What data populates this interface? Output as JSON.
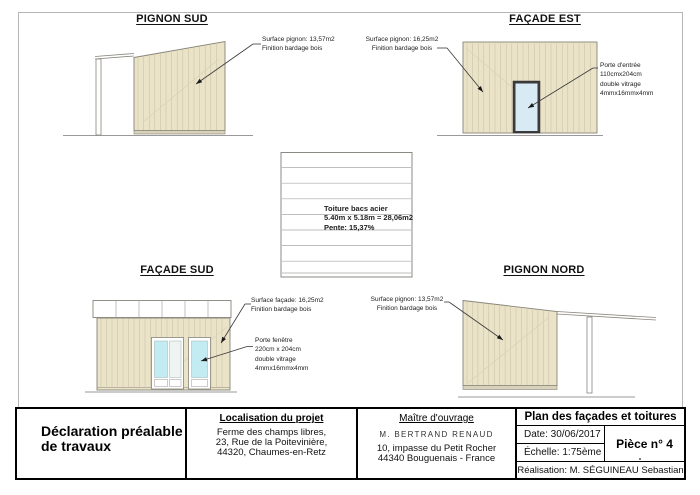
{
  "colors": {
    "cladding_fill": "#eae3c7",
    "cladding_line": "#c6bea2",
    "plinth_fill": "#d9d2ba",
    "outline": "#87847a",
    "glass_blue": "#c2ecf2",
    "glass_pale": "#edf4f2",
    "door_glass": "#d8ebf4",
    "door_frame": "#3c3c3c"
  },
  "views": {
    "pignon_sud": {
      "title": "PIGNON SUD",
      "surface": [
        "Surface pignon: 13,57m2",
        "Finition bardage bois"
      ]
    },
    "facade_est": {
      "title": "FAÇADE EST",
      "surface": [
        "Surface pignon: 16,25m2",
        "Finition bardage bois"
      ],
      "door": [
        "Porte d'entrée",
        "110cmx204cm",
        "double vitrage",
        "4mmx16mmx4mm"
      ]
    },
    "roof_plan": {
      "label": [
        "Toiture bacs acier",
        "5.40m x 5.18m = 28,06m2",
        "Pente: 15,37%"
      ]
    },
    "facade_sud": {
      "title": "FAÇADE SUD",
      "surface": [
        "Surface façade: 16,25m2",
        "Finition bardage bois"
      ],
      "window": [
        "Porte fenêtre",
        "220cm x 204cm",
        "double vitrage",
        "4mmx16mmx4mm"
      ]
    },
    "pignon_nord": {
      "title": "PIGNON NORD",
      "surface": [
        "Surface pignon: 13,57m2",
        "Finition bardage bois"
      ]
    }
  },
  "title_block": {
    "declaration": [
      "Déclaration préalable",
      "de travaux"
    ],
    "localisation": {
      "header": "Localisation du projet",
      "address": [
        "Ferme des champs libres,",
        "23, Rue de la Poitevinière,",
        "44320, Chaumes-en-Retz"
      ]
    },
    "maitre_ouvrage": {
      "header": "Maître d'ouvrage",
      "name": "M. BERTRAND RENAUD",
      "address": [
        "10, impasse du Petit Rocher",
        "44340 Bouguenais - France"
      ]
    },
    "plan": {
      "title": "Plan des façades et toitures",
      "date": "Date: 30/06/2017",
      "scale": "Échelle: 1:75ème",
      "piece": "Pièce n° 4",
      "realisation": "Réalisation: M. SÉGUINEAU Sebastian"
    }
  }
}
